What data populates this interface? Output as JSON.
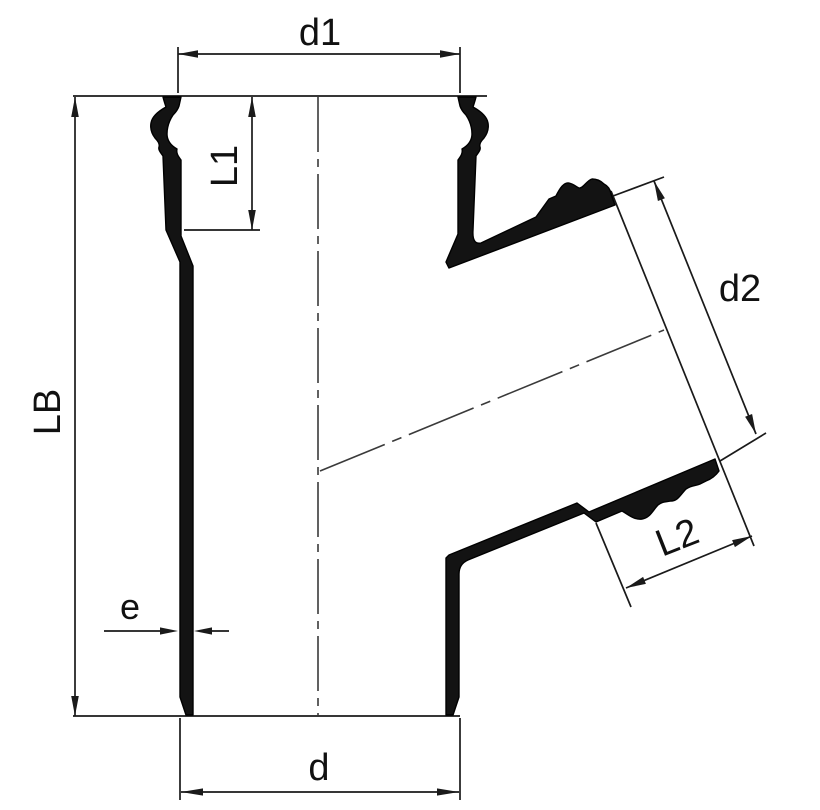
{
  "diagram": {
    "type": "technical-drawing",
    "subject": "pipe-branch-fitting-cross-section",
    "background_color": "#ffffff",
    "line_color": "#1a1a1a",
    "wall_fill_color": "#131313",
    "labels": {
      "d1": "d1",
      "L1": "L1",
      "LB": "LB",
      "d2": "d2",
      "L2": "L2",
      "e": "e",
      "d": "d"
    }
  }
}
